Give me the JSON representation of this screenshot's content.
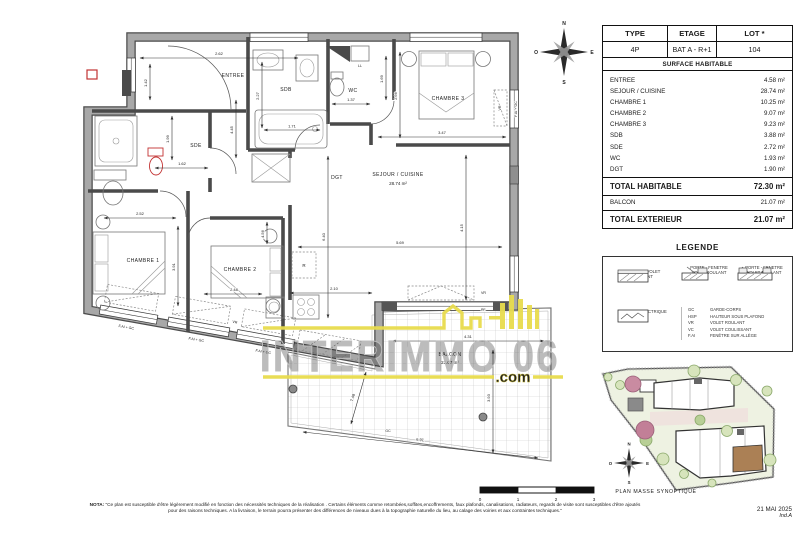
{
  "header_table": {
    "columns": [
      "TYPE",
      "ETAGE",
      "LOT *"
    ],
    "values": [
      "4P",
      "BAT A - R+1",
      "104"
    ]
  },
  "surface_table": {
    "title": "SURFACE HABITABLE",
    "rows": [
      {
        "label": "ENTREE",
        "value": "4.58 m²"
      },
      {
        "label": "SEJOUR / CUISINE",
        "value": "28.74 m²"
      },
      {
        "label": "CHAMBRE 1",
        "value": "10.25 m²"
      },
      {
        "label": "CHAMBRE 2",
        "value": "9.07 m²"
      },
      {
        "label": "CHAMBRE 3",
        "value": "9.23 m²"
      },
      {
        "label": "SDB",
        "value": "3.88 m²"
      },
      {
        "label": "SDE",
        "value": "2.72 m²"
      },
      {
        "label": "WC",
        "value": "1.93 m²"
      },
      {
        "label": "DGT",
        "value": "1.90 m²"
      }
    ],
    "total_habitable": {
      "label": "TOTAL HABITABLE",
      "value": "72.30 m²"
    },
    "balcon": {
      "label": "BALCON",
      "value": "21.07 m²"
    },
    "total_exterieur": {
      "label": "TOTAL EXTERIEUR",
      "value": "21.07 m²"
    }
  },
  "legend": {
    "title": "LEGENDE",
    "item1": "FENETRE-VOLET ROULANT",
    "item2_line1": "PORTE - FENETRE",
    "item2_line2": "VOLET ROULANT",
    "item3_line1": "PORTE - FENETRE",
    "item3_line2": "VOLET ROULANT",
    "item4": "PLACARD ELECTRIQUE",
    "abbreviations": [
      {
        "abbr": "GC",
        "meaning": "GARDE-CORPS"
      },
      {
        "abbr": "HSP",
        "meaning": "HAUTEUR SOUS PLAFOND"
      },
      {
        "abbr": "VR",
        "meaning": "VOLET ROULANT"
      },
      {
        "abbr": "VC",
        "meaning": "VOLET COULISSANT"
      },
      {
        "abbr": "F.AI",
        "meaning": "FENÊTRE SUR ALLÈGE"
      }
    ]
  },
  "site_plan": {
    "caption": "PLAN MASSE SYNOPTIQUE"
  },
  "compass": {
    "n": "N",
    "s": "S",
    "e": "E",
    "o": "O"
  },
  "scale_bar": {
    "ticks": [
      "0",
      "1",
      "2",
      "3"
    ]
  },
  "date": {
    "line1": "21 MAI 2025",
    "line2": "Ind.A"
  },
  "nota": {
    "label": "NOTA:",
    "text": "\"Ce plan est susceptible d'être légèrement modifié en fonction des nécessités techniques de la réalisation . Certains éléments comme retombées,soffites,encoffrements, faux plafonds, canalisations, radiateurs, regards de visite sont susceptibles d'être ajoutés pour des raisons techniques. A la livraison, le terrain pourra présenter des différences de niveaux dues à la topographie naturelle du lieu, au calage des voiries et aux contraintes techniques.\""
  },
  "watermark": {
    "text": "INTERIMMO 06",
    "suffix": ".com"
  },
  "floor_plan": {
    "rooms": {
      "entree": "ENTREE",
      "sdb": "SDB",
      "wc": "WC",
      "ch3": "CHAMBRE 3",
      "sejour": "SEJOUR / CUISINE",
      "sejour_area": "28.74 m²",
      "ch1": "CHAMBRE 1",
      "ch2": "CHAMBRE 2",
      "sde": "SDE",
      "dgt": "DGT",
      "balcon": "BALCON",
      "balcon_area": "21.07 m²"
    },
    "dims": {
      "entree_w": "2.62",
      "entree_h": "1.42",
      "sdb_h": "2.27",
      "bath_w": "1.71",
      "wc_w": "1.37",
      "wc_h": "1.69",
      "ch3_h": "2.66",
      "ch3_w": "3.47",
      "dgt_h": "4.45",
      "sde_w": "1.62",
      "sde_h": "1.99",
      "ch1_w": "2.52",
      "ch1_h": "3.91",
      "ch2_w": "2.48",
      "ch2_h": "4.56",
      "sej_h": "6.40",
      "sej_w": "5.69",
      "sej_h2": "4.15",
      "kit_w": "2.10",
      "bal_w": "4.31",
      "bal_h": "3.93",
      "bal_b": "6.91",
      "bal_d": "7.48"
    },
    "tags": {
      "pf": "PF",
      "vr": "VR",
      "gc": "GC",
      "fai_gc": "F.AI + GC",
      "ll": "LL",
      "r": "R"
    }
  },
  "colors": {
    "watermark_yellow": "#e8dc4e",
    "wall_gray": "#a8a8a8",
    "site_green": "#eef2e2",
    "unit_brown": "#ab8055"
  }
}
